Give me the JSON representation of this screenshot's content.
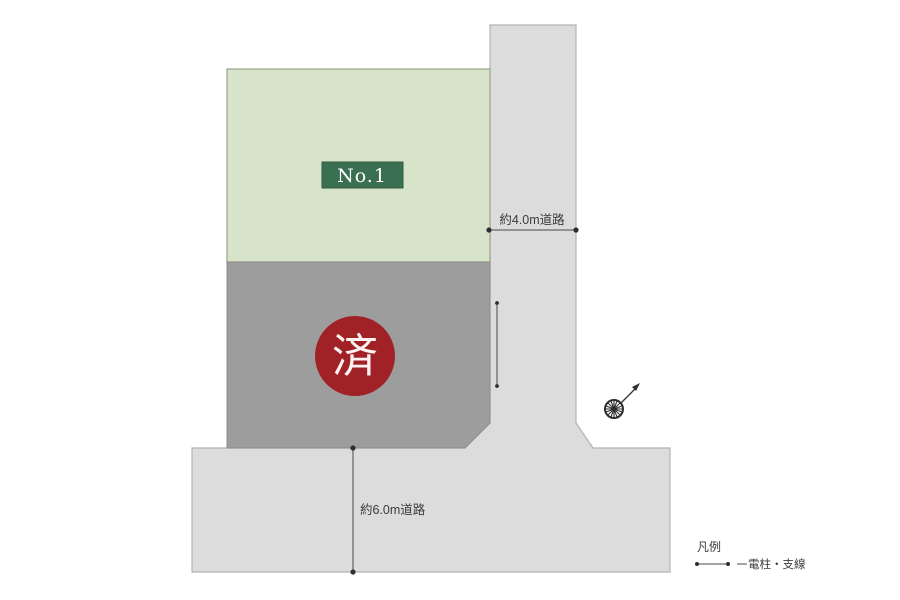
{
  "diagram": {
    "plots": [
      {
        "id": "plot-1",
        "label": "No.1",
        "status": "available"
      },
      {
        "id": "plot-sold",
        "stamp": "済",
        "status": "sold"
      }
    ],
    "roads": {
      "vertical": {
        "label": "約4.0m道路"
      },
      "horizontal": {
        "label": "約6.0m道路"
      }
    },
    "legend": {
      "title": "凡例",
      "pole_wire_label": "電柱・支線"
    }
  },
  "colors": {
    "background": "#ffffff",
    "plot_available_fill": "#d8e4ca",
    "plot_sold_fill": "#9d9d9d",
    "road_fill": "#dcdcdc",
    "label_box_fill": "#3a6f51",
    "stamp_fill": "#a02227",
    "measure_ink": "#3b3b3b"
  }
}
